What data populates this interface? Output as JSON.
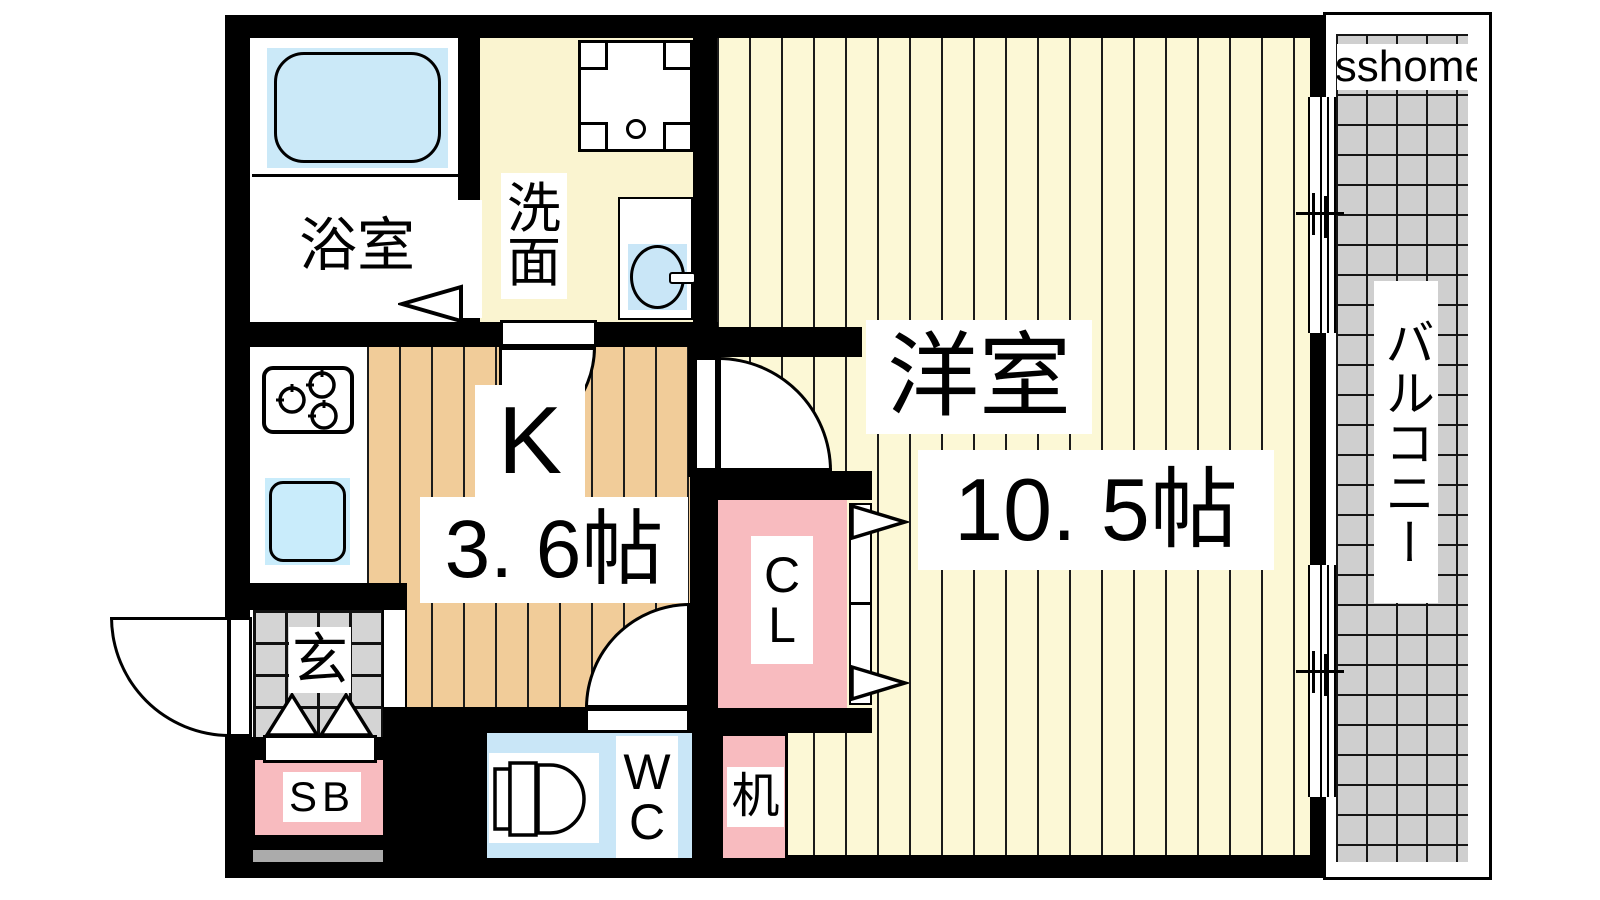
{
  "watermark": {
    "text": "isshome"
  },
  "rooms": {
    "bath": {
      "label": "浴室"
    },
    "washroom": {
      "line1": "洗",
      "line2": "面"
    },
    "kitchen": {
      "label": "K",
      "size": "3. 6帖"
    },
    "entrance": {
      "label": "玄"
    },
    "shoebox": {
      "label": "SB"
    },
    "toilet": {
      "line1": "W",
      "line2": "C"
    },
    "closet": {
      "line1": "C",
      "line2": "L"
    },
    "desk": {
      "label": "机"
    },
    "main": {
      "label": "洋室",
      "size": "10. 5帖"
    },
    "balcony": {
      "label": "バルコニー"
    }
  },
  "fixtures": {
    "bathtub": "bathtub-icon",
    "washer_pan": "washing-machine-pan-icon",
    "washbasin": "washbasin-icon",
    "stove": "gas-stove-icon",
    "kitchen_sink": "kitchen-sink-icon",
    "toilet": "toilet-icon",
    "door_swing": "door-swing-arc-icon",
    "folding_door": "folding-door-triangle-icon",
    "window": "sliding-window-icon"
  },
  "colors": {
    "wall": "#000000",
    "room_cream": "#FCF8D6",
    "kitchen_wood": "#F1CC99",
    "accent_pink": "#F8BBBF",
    "water_blue": "#C9E6F7",
    "tile_gray": "#D4D4D4",
    "balcony_gray": "#CFCFCF"
  }
}
